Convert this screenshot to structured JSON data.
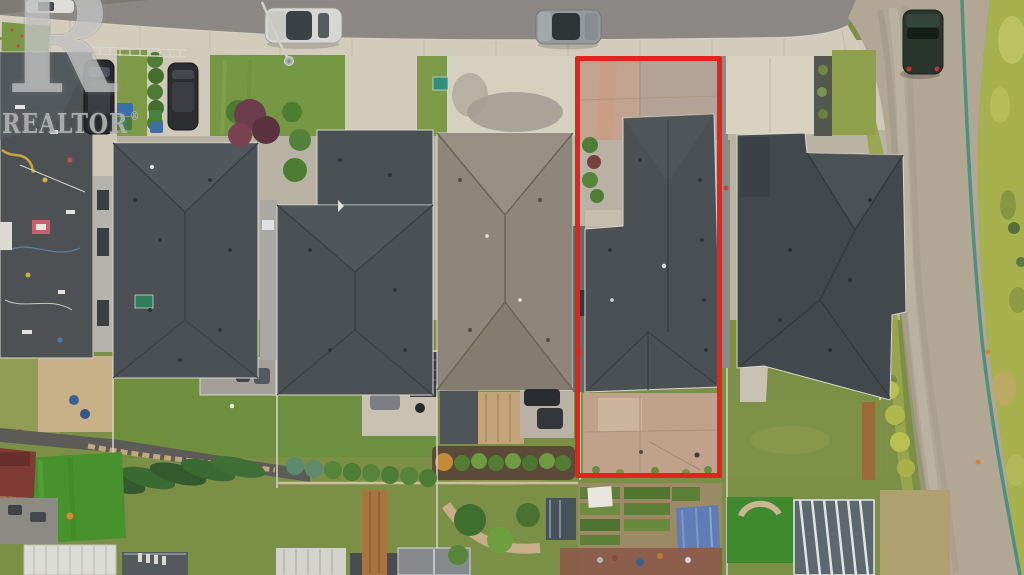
{
  "meta": {
    "description": "Aerial top-down drone photograph of a suburban street; one property lot is outlined in red",
    "image_type": "real-estate listing photo"
  },
  "watermark": {
    "logo_letter": "R",
    "brand": "REALTOR",
    "registered_mark": "®"
  },
  "colors": {
    "outline-red": "#e5231c",
    "roof-charcoal": "#4a5054",
    "roof-taupe": "#8e867a",
    "asphalt": "#8a8784",
    "concrete": "#d3ccbc",
    "lawn-green": "#7a9746",
    "gravel": "#b2a795",
    "utility-line-teal": "#4f8f80",
    "tarp-blue": "#5f7cb4",
    "turf-green": "#47922c"
  },
  "scene": {
    "subject_lot": {
      "outlined": true,
      "outline_color_key": "outline-red",
      "contents": [
        "front driveway",
        "house with dark shingle roof",
        "bare concrete backyard patio"
      ]
    },
    "street": {
      "position": "top",
      "parked_vehicles": [
        "white car (edge of frame)",
        "silver SUV",
        "grey sedan"
      ]
    },
    "side_road": {
      "position": "right",
      "surface": "gravel",
      "parked_vehicles": [
        "dark green SUV"
      ]
    },
    "driveway_vehicles": [
      "black SUV",
      "dark sedan",
      "two dark cars behind taupe-roof house"
    ],
    "houses_visible": 6,
    "backyards": [
      "lawns",
      "decks with furniture",
      "sand play area",
      "leaning spruce row",
      "vegetable garden beds",
      "blue tarp",
      "greenhouse / ribbed canopy",
      "artificial turf"
    ]
  }
}
